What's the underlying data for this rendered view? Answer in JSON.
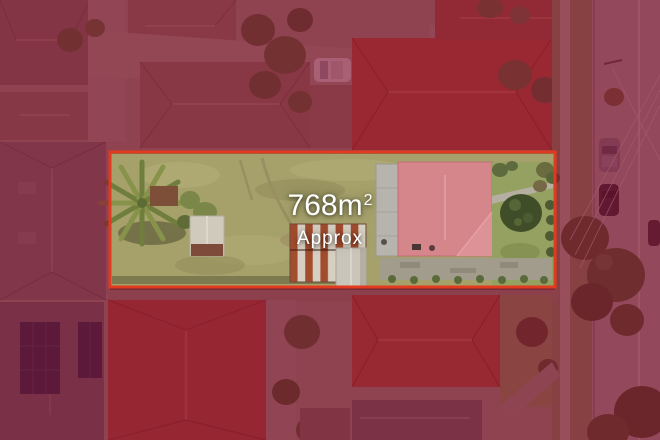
{
  "area_label": {
    "value": "768m",
    "superscript": "2",
    "qualifier": "Approx"
  },
  "colors": {
    "boundary": "#e23a1e",
    "tint": "rgba(134,5,41,0.57)",
    "label_text": "#ffffff"
  }
}
